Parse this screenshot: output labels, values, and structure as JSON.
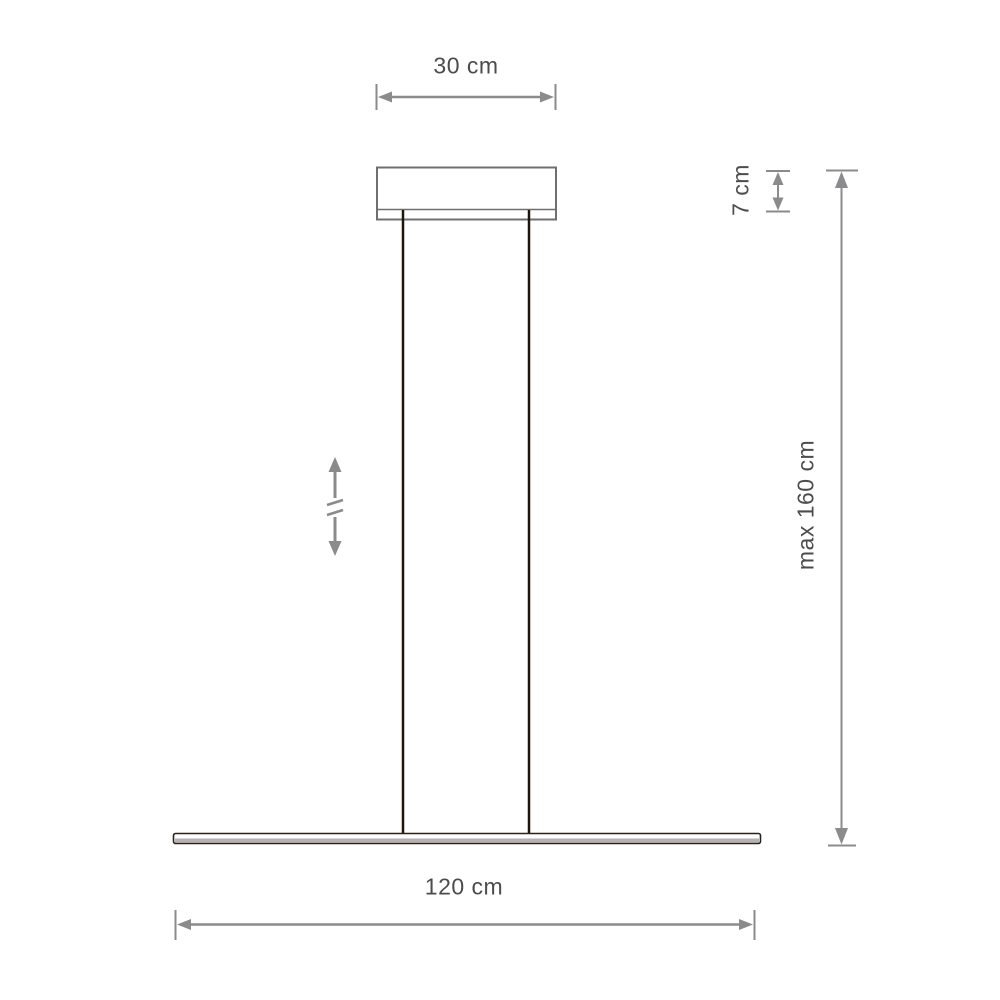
{
  "diagram": {
    "title": "pendant-lamp-dimension-drawing",
    "dimensions": {
      "canopy_width": "30 cm",
      "canopy_height": "7 cm",
      "max_suspension": "max 160 cm",
      "fixture_length": "120 cm"
    }
  },
  "icons": {
    "height_adjustable": "double-arrow-with-break"
  },
  "colors": {
    "dimension_line": "#8b8b8d",
    "label_text": "#4c4c4e",
    "canopy_outline": "#6f6f71",
    "wire": "#20150b",
    "bar_outline": "#2b2118",
    "bar_shade": "#b3b1b1",
    "background": "#ffffff"
  }
}
